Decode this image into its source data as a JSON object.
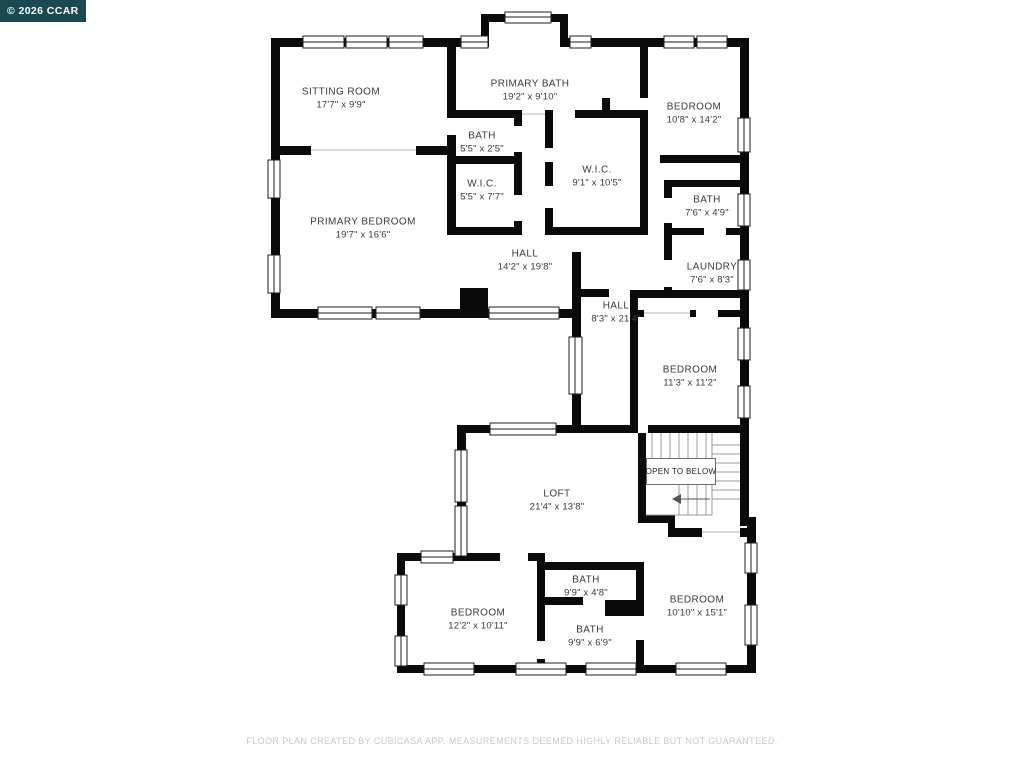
{
  "watermark": {
    "text": "© 2026 CCAR",
    "bg_color": "#1b4851",
    "text_color": "#ffffff"
  },
  "footer": {
    "text": "FLOOR PLAN CREATED BY CUBICASA APP. MEASUREMENTS DEEMED HIGHLY RELIABLE BUT NOT GUARANTEED."
  },
  "plan": {
    "wall_color": "#0a0a0a",
    "floor_color": "#ffffff",
    "open_to_below_label": "OPEN TO BELOW",
    "rooms": [
      {
        "name": "SITTING ROOM",
        "dims": "17'7\" x 9'9\""
      },
      {
        "name": "PRIMARY BATH",
        "dims": "19'2\" x 9'10\""
      },
      {
        "name": "BEDROOM",
        "dims": "10'8\" x 14'2\""
      },
      {
        "name": "BATH",
        "dims": "5'5\" x 2'5\""
      },
      {
        "name": "W.I.C.",
        "dims": "5'5\" x 7'7\""
      },
      {
        "name": "W.I.C.",
        "dims": "9'1\" x 10'5\""
      },
      {
        "name": "PRIMARY BEDROOM",
        "dims": "19'7\" x 16'6\""
      },
      {
        "name": "HALL",
        "dims": "14'2\" x 19'8\""
      },
      {
        "name": "BATH",
        "dims": "7'6\" x 4'9\""
      },
      {
        "name": "LAUNDRY",
        "dims": "7'6\" x 8'3\""
      },
      {
        "name": "HALL",
        "dims": "8'3\" x 21'4\""
      },
      {
        "name": "BEDROOM",
        "dims": "11'3\" x 11'2\""
      },
      {
        "name": "LOFT",
        "dims": "21'4\" x 13'8\""
      },
      {
        "name": "BEDROOM",
        "dims": "12'2\" x 10'11\""
      },
      {
        "name": "BATH",
        "dims": "9'9\" x 4'8\""
      },
      {
        "name": "BATH",
        "dims": "9'9\" x 6'9\""
      },
      {
        "name": "BEDROOM",
        "dims": "10'10\" x 15'1\""
      }
    ]
  }
}
